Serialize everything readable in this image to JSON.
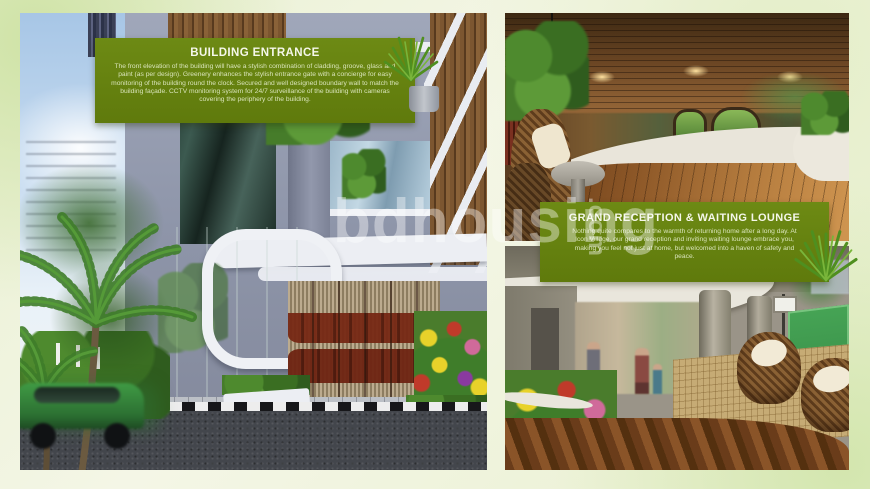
{
  "watermark": {
    "main": "bdhousing",
    "suffix": ".com"
  },
  "callouts": [
    {
      "title": "BUILDING ENTRANCE",
      "body": "The front elevation of the building will have a stylish combination of cladding, groove, glass and paint (as per design). Greenery enhances the stylish entrance gate with a concierge for easy monitoring of the building round the clock. Secured and well designed boundary wall to match the building façade. CCTV monitoring system for 24/7 surveillance of the building with cameras covering the periphery of the building."
    },
    {
      "title": "GRAND RECEPTION & WAITING LOUNGE",
      "body": "Nothing quite compares to the warmth of returning home after a long day. At Icon Village, our grand reception and inviting waiting lounge embrace you, making you feel not just at home, but welcomed into a haven of safety and peace."
    }
  ],
  "photos": [
    {
      "name": "building-entrance-exterior"
    },
    {
      "name": "grand-reception-interior"
    },
    {
      "name": "ground-floor-lounge"
    }
  ],
  "colors": {
    "accent_green": "#66810f",
    "page_background": "#eef2da",
    "watermark_white": "rgba(255,255,255,0.40)"
  }
}
